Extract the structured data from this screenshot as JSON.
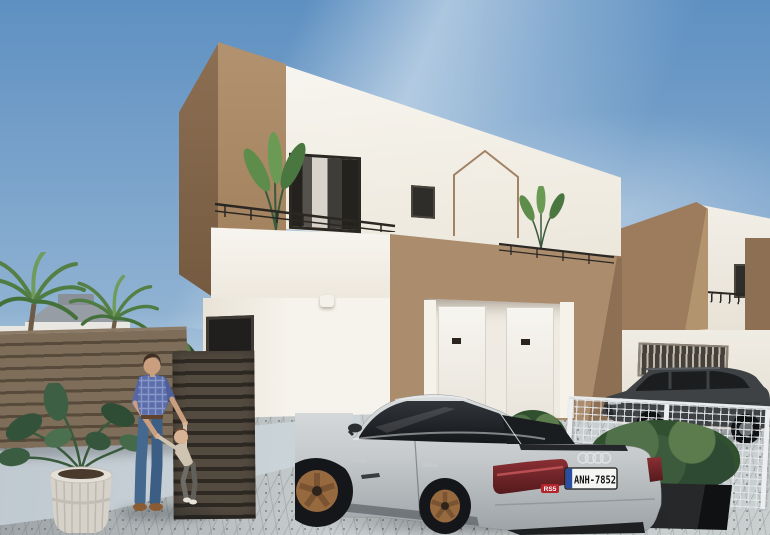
{
  "scene": {
    "type": "architectural-exterior-render",
    "description": "New-build two-storey villas in white and tan stucco with roof terraces, cobbled driveway, silver sportback parked by the garage, man playing with a toddler, palm trees and planters",
    "objects": [
      "sky",
      "background-houses",
      "palm-trees",
      "main-villa",
      "neighbor-villa",
      "wooden-slat-fence",
      "entrance-gate",
      "wire-mesh-fence",
      "hedge-planters",
      "potted-plant",
      "cobblestone-driveway",
      "silver-sportback-car",
      "dark-suv",
      "man-and-child"
    ]
  },
  "car": {
    "license_plate": "ANH-7852",
    "model_badge": "RS5",
    "brand_icon": "audi-rings-icon"
  },
  "palette": {
    "sky-top": "#5e90c1",
    "sky-mid": "#8fb2d2",
    "sky-horizon": "#cddbe6",
    "wall-white": "#f4f1ea",
    "wall-white-shade": "#e6e0d4",
    "wall-tan": "#ab8c6c",
    "wall-tan-dark": "#8d6f53",
    "wall-tan-deep": "#73593f",
    "fence-slat": "#7e6d59",
    "fence-gap": "#574a3b",
    "gate-slat": "#544b40",
    "gate-gap": "#2e2923",
    "pavement": "#c9cecf",
    "walkway": "#c6d0d6",
    "car-silver": "#c8cccd",
    "glass-dark": "#232629",
    "taillight-red": "#6e2428",
    "plate-white": "#f5f5f3",
    "plate-blue": "#2b4ea0",
    "badge-red": "#b5232d",
    "wheel-bronze": "#96693f",
    "leaf-green": "#567f45",
    "leaf-dark": "#35502f",
    "suv-grey": "#3f4245",
    "railing-dark": "#2b2722",
    "roof-grey": "#979da4",
    "skin": "#c99f80",
    "shirt-blue": "#5b6ea9",
    "jeans-blue": "#45688f"
  }
}
